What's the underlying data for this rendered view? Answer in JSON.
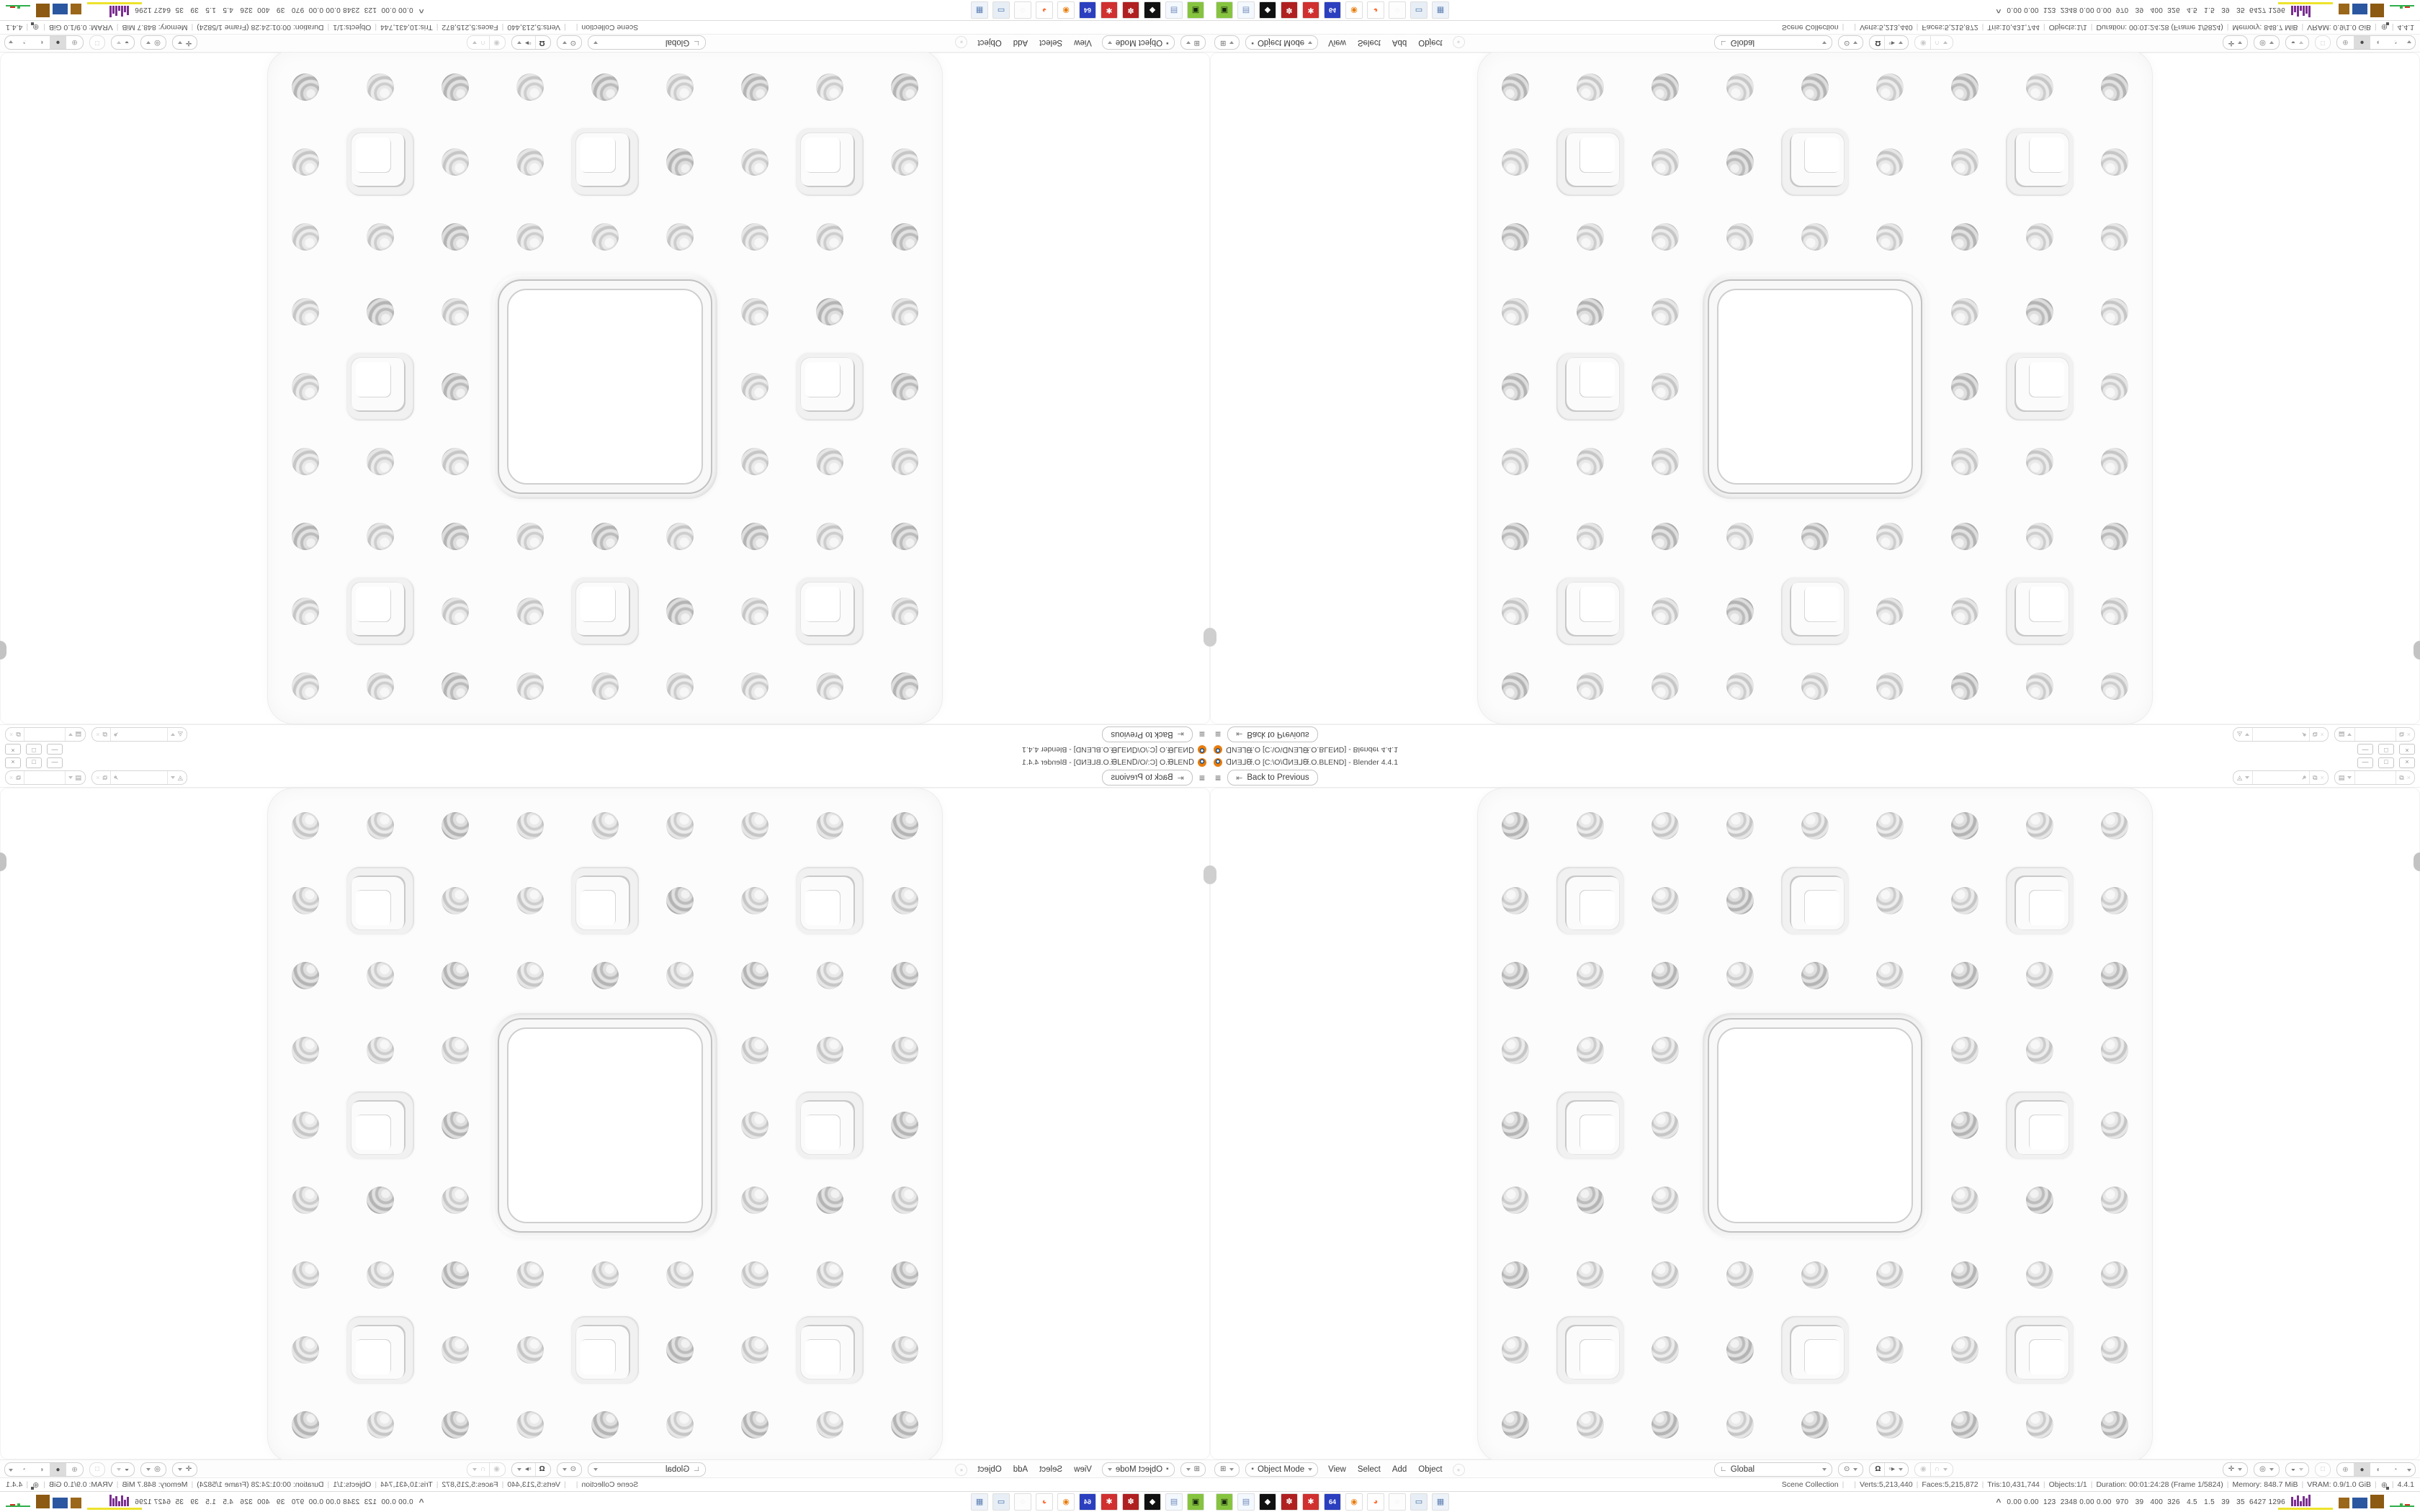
{
  "window": {
    "title": "ᗡИƎ⅃ᙠ.O [C:\\O\\ᗡИƎ⅃ᙠ.O.BLEND] - Blender 4.4.1",
    "controls": {
      "minimize": "—",
      "restore": "□",
      "close": "×"
    }
  },
  "topbar": {
    "back_button": "Back to Previous"
  },
  "viewport_header": {
    "mode": "Object Mode",
    "menus": [
      "View",
      "Select",
      "Add",
      "Object"
    ],
    "orientation": "Global"
  },
  "statusbar": {
    "segments": [
      "Scene Collection",
      "",
      "Verts:5,213,440",
      "Faces:5,215,872",
      "Tris:10,431,744",
      "Objects:1/1",
      "Duration: 00:01:24:28 (Frame 1/5824)",
      "Memory: 848.7 MiB",
      "VRAM: 0.9/1.0 GiB"
    ],
    "version": "4.4.1"
  },
  "taskbar": {
    "icons": [
      {
        "name": "gpu-monitor-icon",
        "bg": "#86c440",
        "glyph": "▣",
        "fg": "#14260c"
      },
      {
        "name": "notepad-icon",
        "bg": "#f4f9ff",
        "glyph": "▤",
        "fg": "#6b87b8"
      },
      {
        "name": "image-viewer-icon",
        "bg": "#111111",
        "glyph": "◆",
        "fg": "#ffffff"
      },
      {
        "name": "aida64-badge-icon",
        "bg": "#b02020",
        "glyph": "✽",
        "fg": "#ffffff"
      },
      {
        "name": "red-gear-icon",
        "bg": "#d03030",
        "glyph": "✱",
        "fg": "#ffffff"
      },
      {
        "name": "floppy-64-icon",
        "bg": "#2b3fbf",
        "glyph": "64",
        "fg": "#ffffff"
      },
      {
        "name": "blender-app-icon",
        "bg": "#ffffff",
        "glyph": "◉",
        "fg": "#e87d0d"
      },
      {
        "name": "firefox-icon",
        "bg": "#ffffff",
        "glyph": "◕",
        "fg": "#ff7139"
      },
      {
        "name": "ghost-app-icon",
        "bg": "#fdfdfd",
        "glyph": "○",
        "fg": "#eeeeee"
      },
      {
        "name": "remote-desktop-icon",
        "bg": "#e8eef5",
        "glyph": "▭",
        "fg": "#3a6ea5"
      },
      {
        "name": "calculator-icon",
        "bg": "#eef3fa",
        "glyph": "▦",
        "fg": "#5b7db1"
      }
    ],
    "tray_expand": "^",
    "tray_text": "0.00 0.00  123  2348 0.00 0.00  970   39   400  326   4.5   1.5   39   35  6427 1296",
    "hist_heights": [
      13,
      9,
      15,
      7,
      14,
      11,
      16
    ]
  },
  "viewport": {
    "sponge": {
      "grid": 9,
      "cell": 104,
      "circle_d": 38,
      "square_size": 94,
      "big_square_size": 312
    }
  }
}
